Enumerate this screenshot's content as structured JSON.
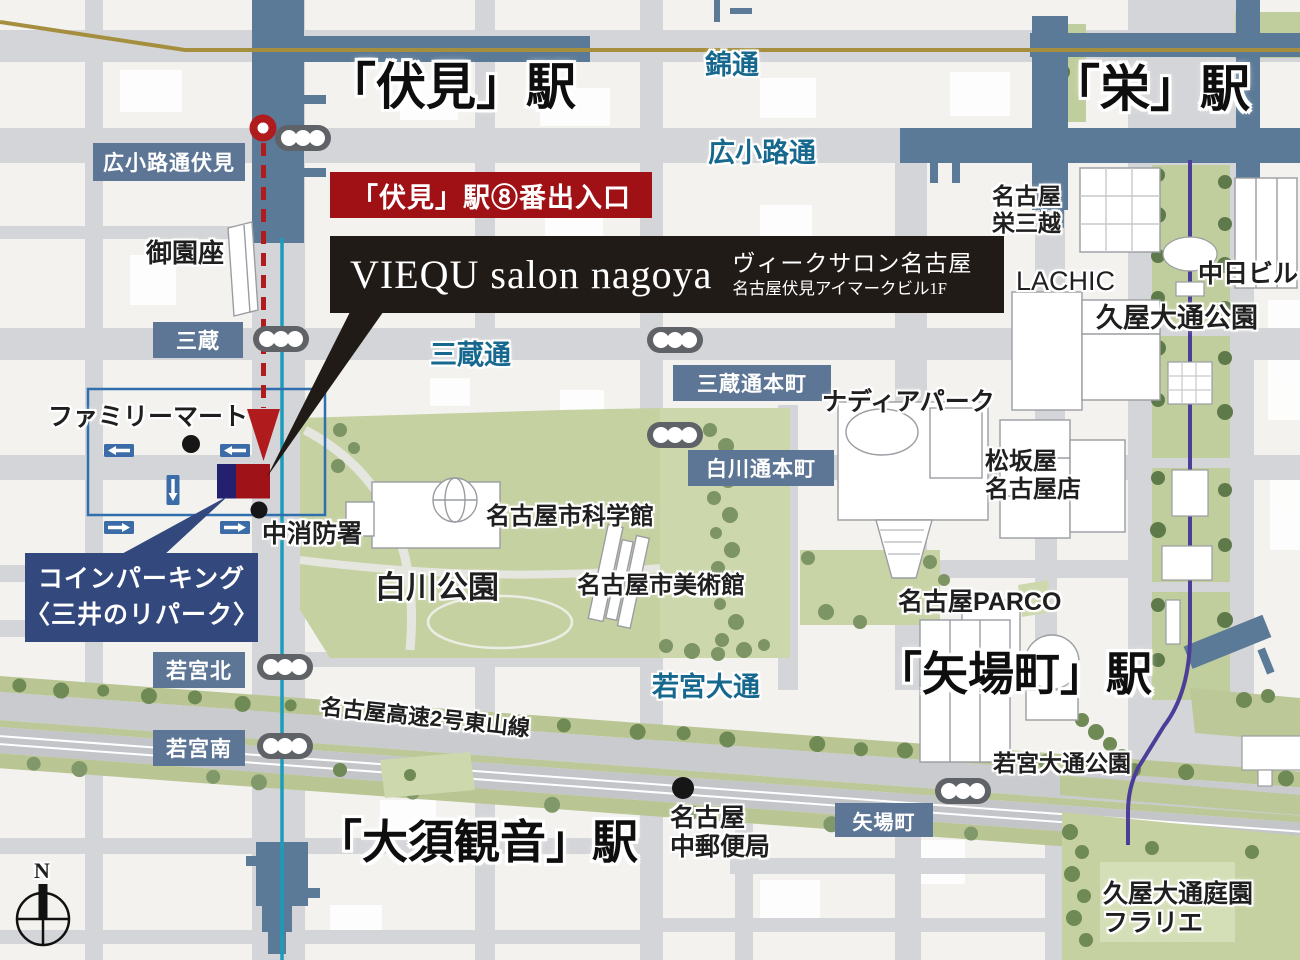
{
  "stations": {
    "fushimi": "「伏見」駅",
    "sakae": "「栄」駅",
    "yabacho": "「矢場町」駅",
    "osukannon": "「大須観音」駅"
  },
  "streets": {
    "nishiki": "錦通",
    "hirokoji": "広小路通",
    "sanzo": "三蔵通",
    "wakamiya": "若宮大通",
    "expressway": "名古屋高速2号東山線"
  },
  "signs": {
    "hirokoji_fushimi": "広小路通伏見",
    "sanzo": "三蔵",
    "sanzo_honmachi": "三蔵通本町",
    "shirakawa_honmachi": "白川通本町",
    "wakamiya_kita": "若宮北",
    "wakamiya_minami": "若宮南",
    "yabacho": "矢場町"
  },
  "pois": {
    "misonoza": "御園座",
    "familymart": "ファミリーマート",
    "fire_station": "中消防署",
    "science_museum": "名古屋市科学館",
    "shirakawa_park": "白川公園",
    "art_museum": "名古屋市美術館",
    "nadia_park": "ナディアパーク",
    "matsuzakaya_1": "松坂屋",
    "matsuzakaya_2": "名古屋店",
    "parco": "名古屋PARCO",
    "mitsukoshi_1": "名古屋",
    "mitsukoshi_2": "栄三越",
    "lachic": "LACHIC",
    "chunichi": "中日ビル",
    "hisaya_park": "久屋大通公園",
    "wakamiya_park": "若宮大通公園",
    "post_office_1": "名古屋",
    "post_office_2": "中郵便局",
    "flarie_1": "久屋大通庭園",
    "flarie_2": "フラリエ"
  },
  "callouts": {
    "exit": "「伏見」駅⑧番出入口",
    "salon_en": "VIEQU salon nagoya",
    "salon_ja": "ヴィークサロン名古屋",
    "salon_addr": "名古屋伏見アイマークビル1F",
    "parking_1": "コインパーキング",
    "parking_2": "〈三井のリパーク〉"
  },
  "compass": {
    "north": "N"
  },
  "colors": {
    "station_blue": "#5b7a97",
    "sign_blue": "#5d7695",
    "route_red": "#b01b1e",
    "exit_box_red": "#a01115",
    "salon_box_black": "#211b17",
    "parking_navy": "#33497e",
    "marker_red": "#9f1318",
    "marker_navy": "#232070",
    "subway_cyan": "#1b9cba",
    "subway_purple": "#4c3d98",
    "rail_gold": "#a58f3f",
    "park_green": "#c5d1a1",
    "road_gray": "#d4d5d8",
    "street_text_blue": "#17688e"
  }
}
